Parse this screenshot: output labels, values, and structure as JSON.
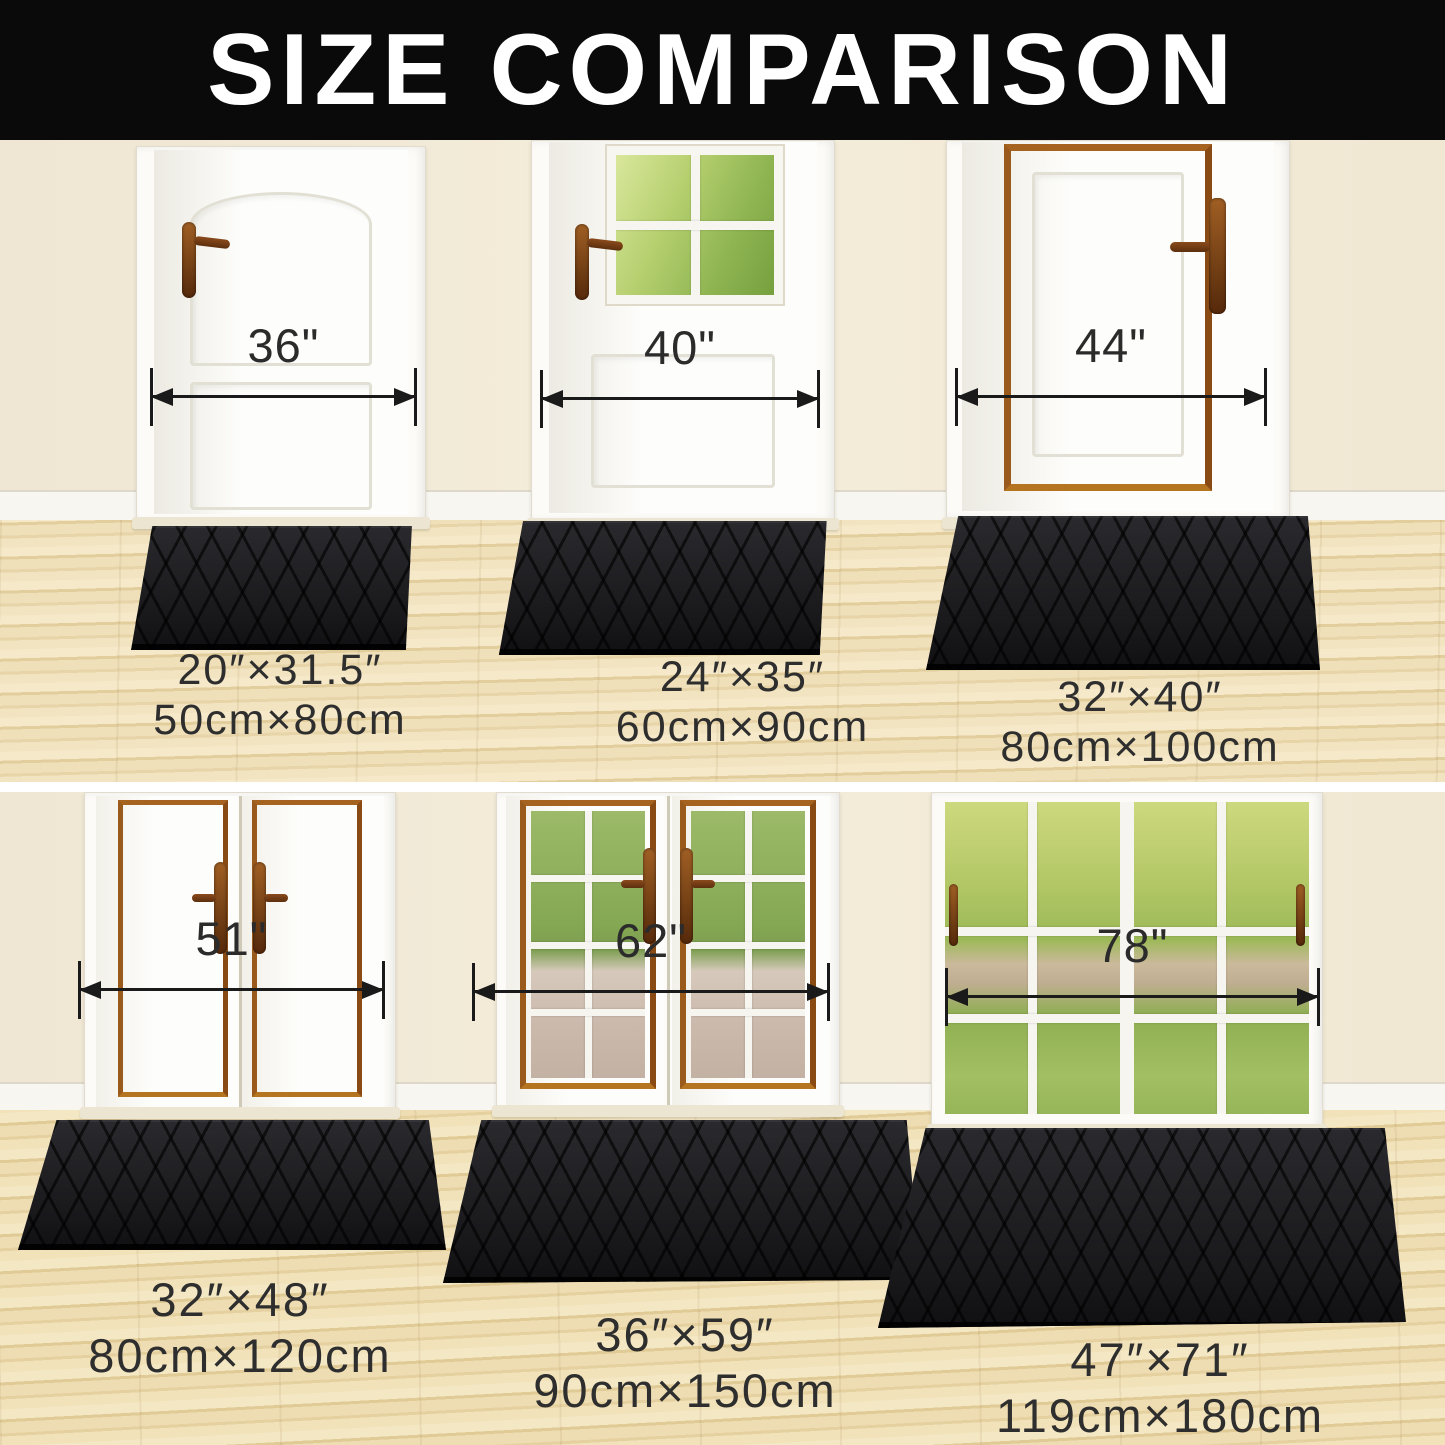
{
  "header": {
    "title": "SIZE COMPARISON"
  },
  "sections": {
    "top": {
      "mats": [
        {
          "door_width": "36\"",
          "inches": "20″×31.5″",
          "cm": "50cm×80cm"
        },
        {
          "door_width": "40\"",
          "inches": "24″×35″",
          "cm": "60cm×90cm"
        },
        {
          "door_width": "44\"",
          "inches": "32″×40″",
          "cm": "80cm×100cm"
        }
      ]
    },
    "bottom": {
      "mats": [
        {
          "door_width": "51\"",
          "inches": "32″×48″",
          "cm": "80cm×120cm"
        },
        {
          "door_width": "62\"",
          "inches": "36″×59″",
          "cm": "90cm×150cm"
        },
        {
          "door_width": "78\"",
          "inches": "47″×71″",
          "cm": "119cm×180cm"
        }
      ]
    }
  },
  "colors": {
    "header_bg": "#0a0a0a",
    "title_text": "#ffffff",
    "wall_cream": "#f1e9d8",
    "floor_wood": "#eadcb4",
    "door_white": "#fbfaf7",
    "trim_copper": "#9a5a22",
    "mat_black": "#1d1d1f",
    "measure_ink": "#1a1a1a",
    "label_ink": "#2e2e2e"
  }
}
